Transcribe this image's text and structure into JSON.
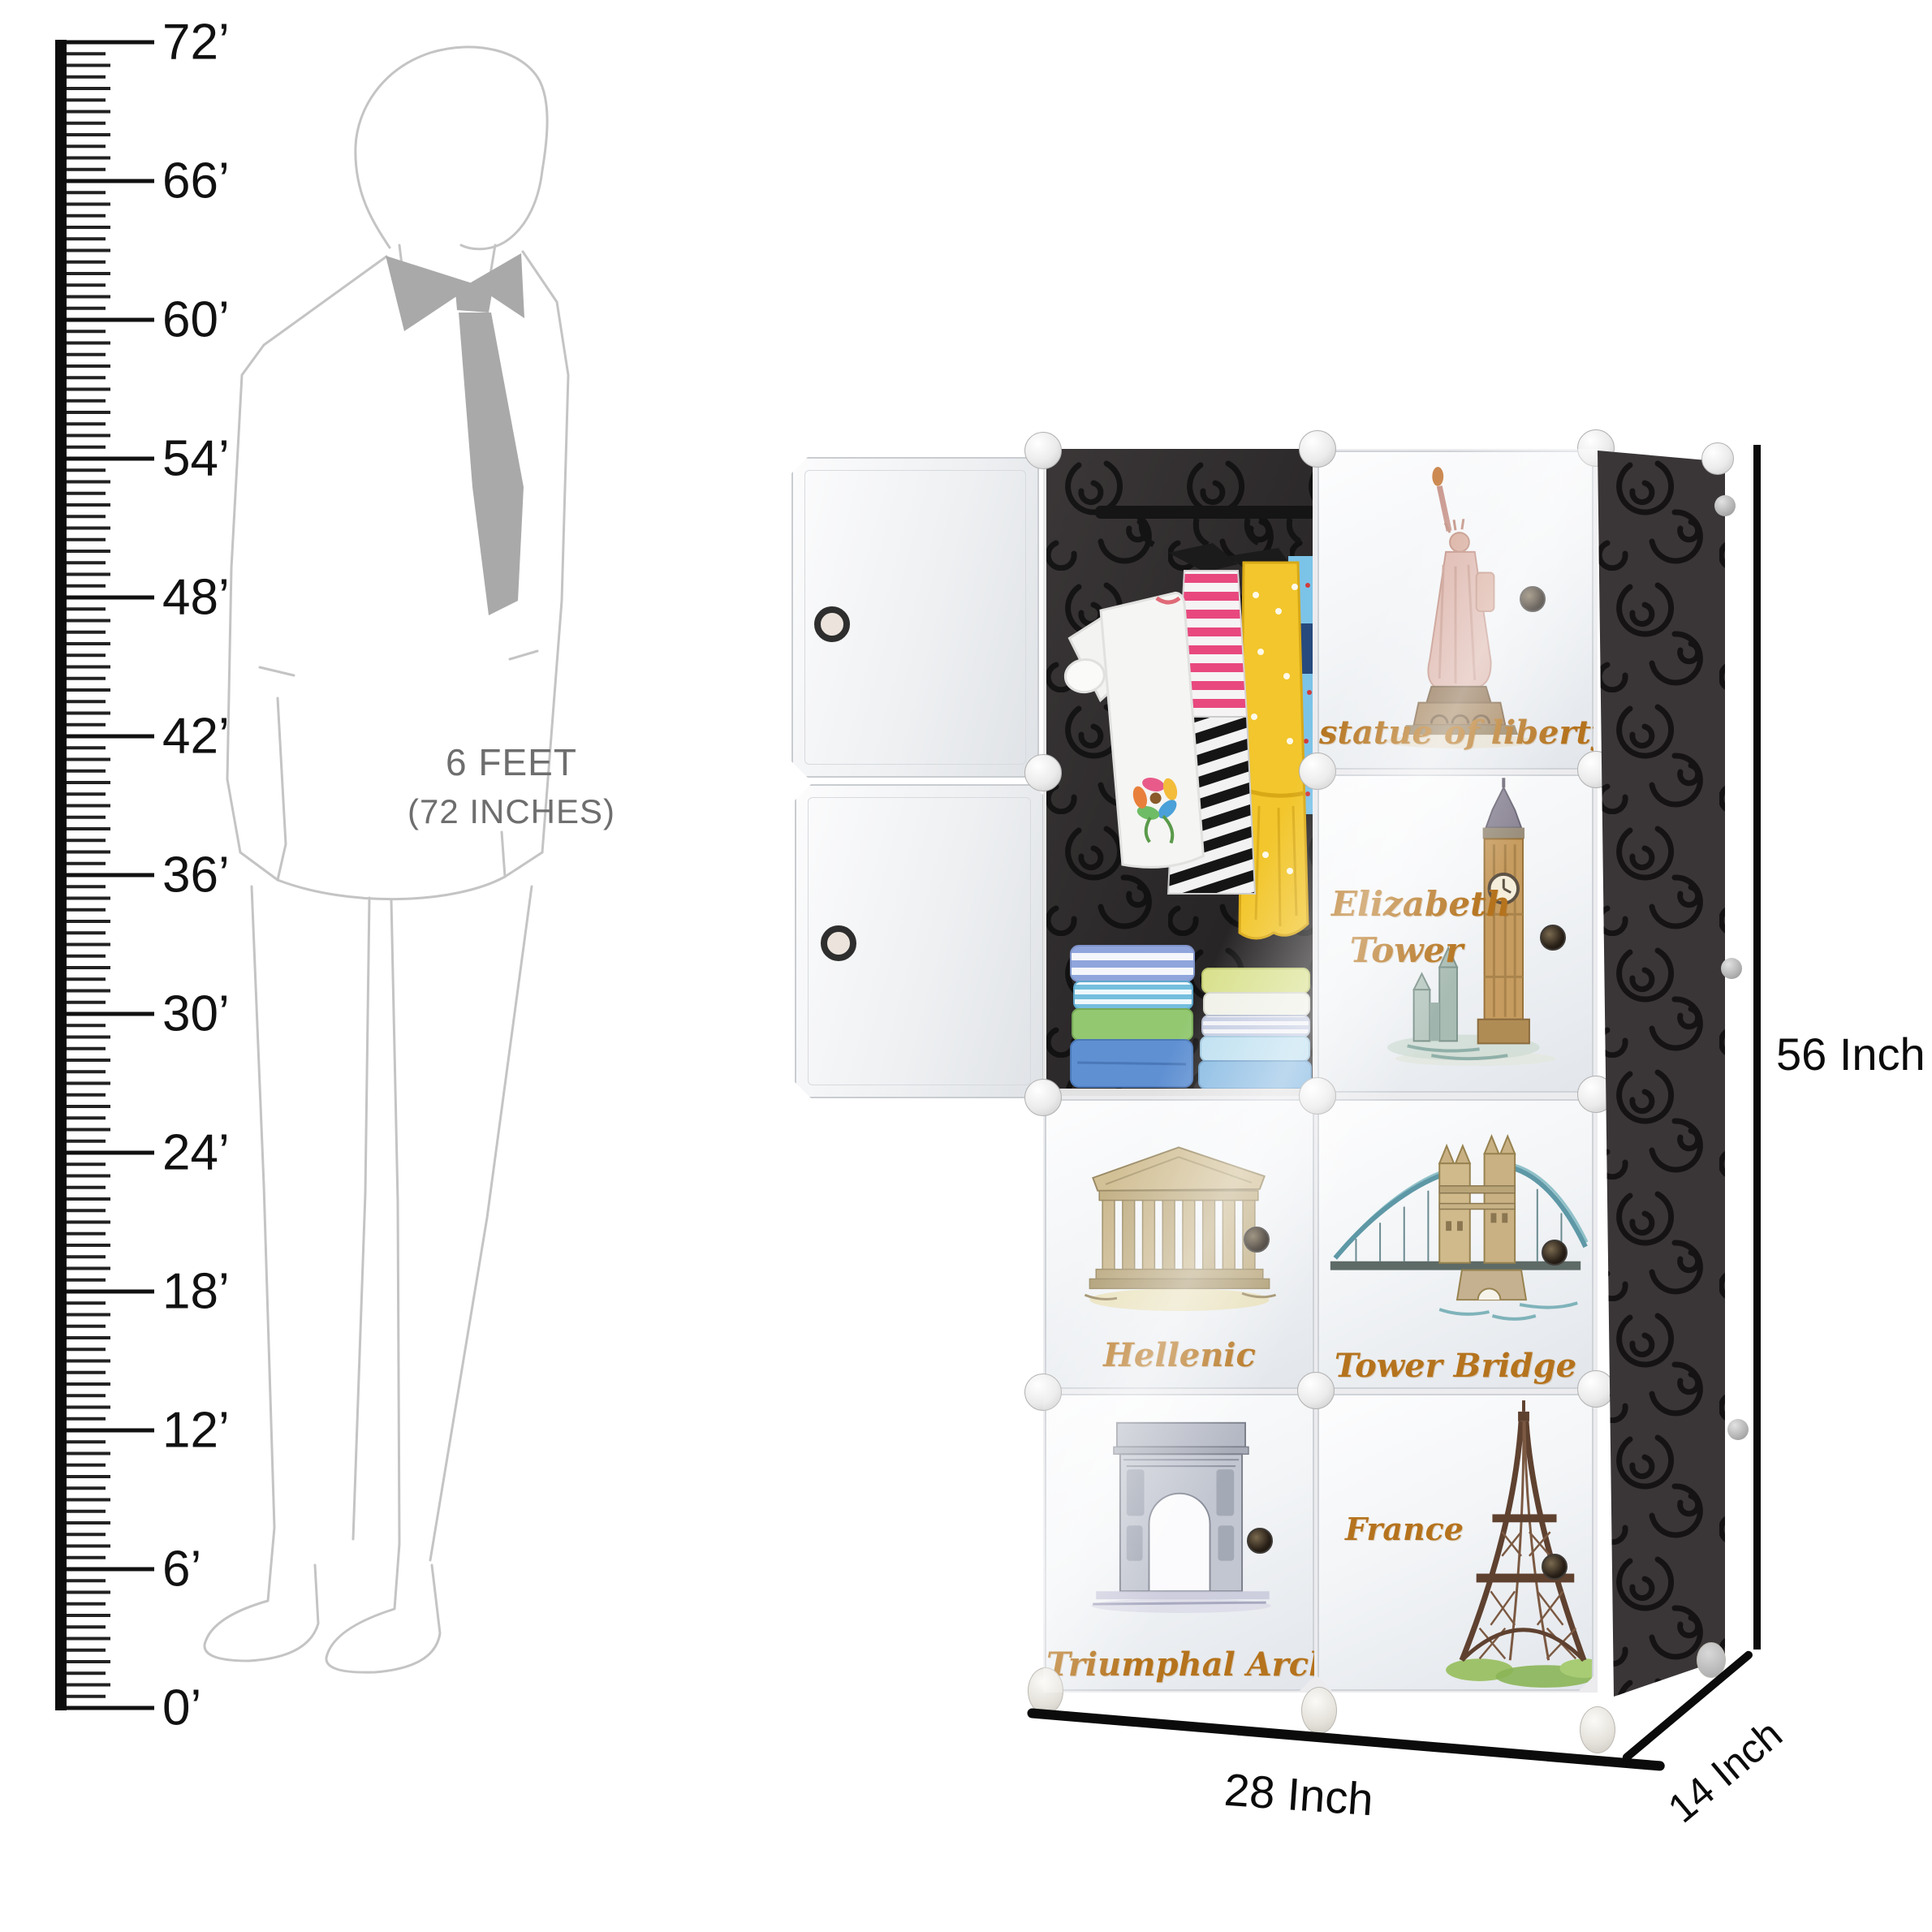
{
  "ruler": {
    "labels": [
      "72’",
      "66’",
      "60’",
      "54’",
      "48’",
      "42’",
      "36’",
      "30’",
      "24’",
      "18’",
      "12’",
      "6’",
      "0’"
    ]
  },
  "silhouette": {
    "caption_line1": "6 FEET",
    "caption_line2": "(72 INCHES)"
  },
  "wardrobe": {
    "label_color": "#b5731d",
    "interior_color": "#262324",
    "side_color": "#3a3637",
    "doors": [
      {
        "label": "statue of liberty"
      },
      {
        "label": "Elizabeth Tower",
        "label_line1": "Elizabeth",
        "label_line2": "Tower"
      },
      {
        "label": "Hellenic"
      },
      {
        "label": "Tower Bridge"
      },
      {
        "label": "Triumphal Arch"
      },
      {
        "label": "France"
      }
    ]
  },
  "dimensions": {
    "height": "56 Inch",
    "width": "28 Inch",
    "depth": "14 Inch"
  }
}
